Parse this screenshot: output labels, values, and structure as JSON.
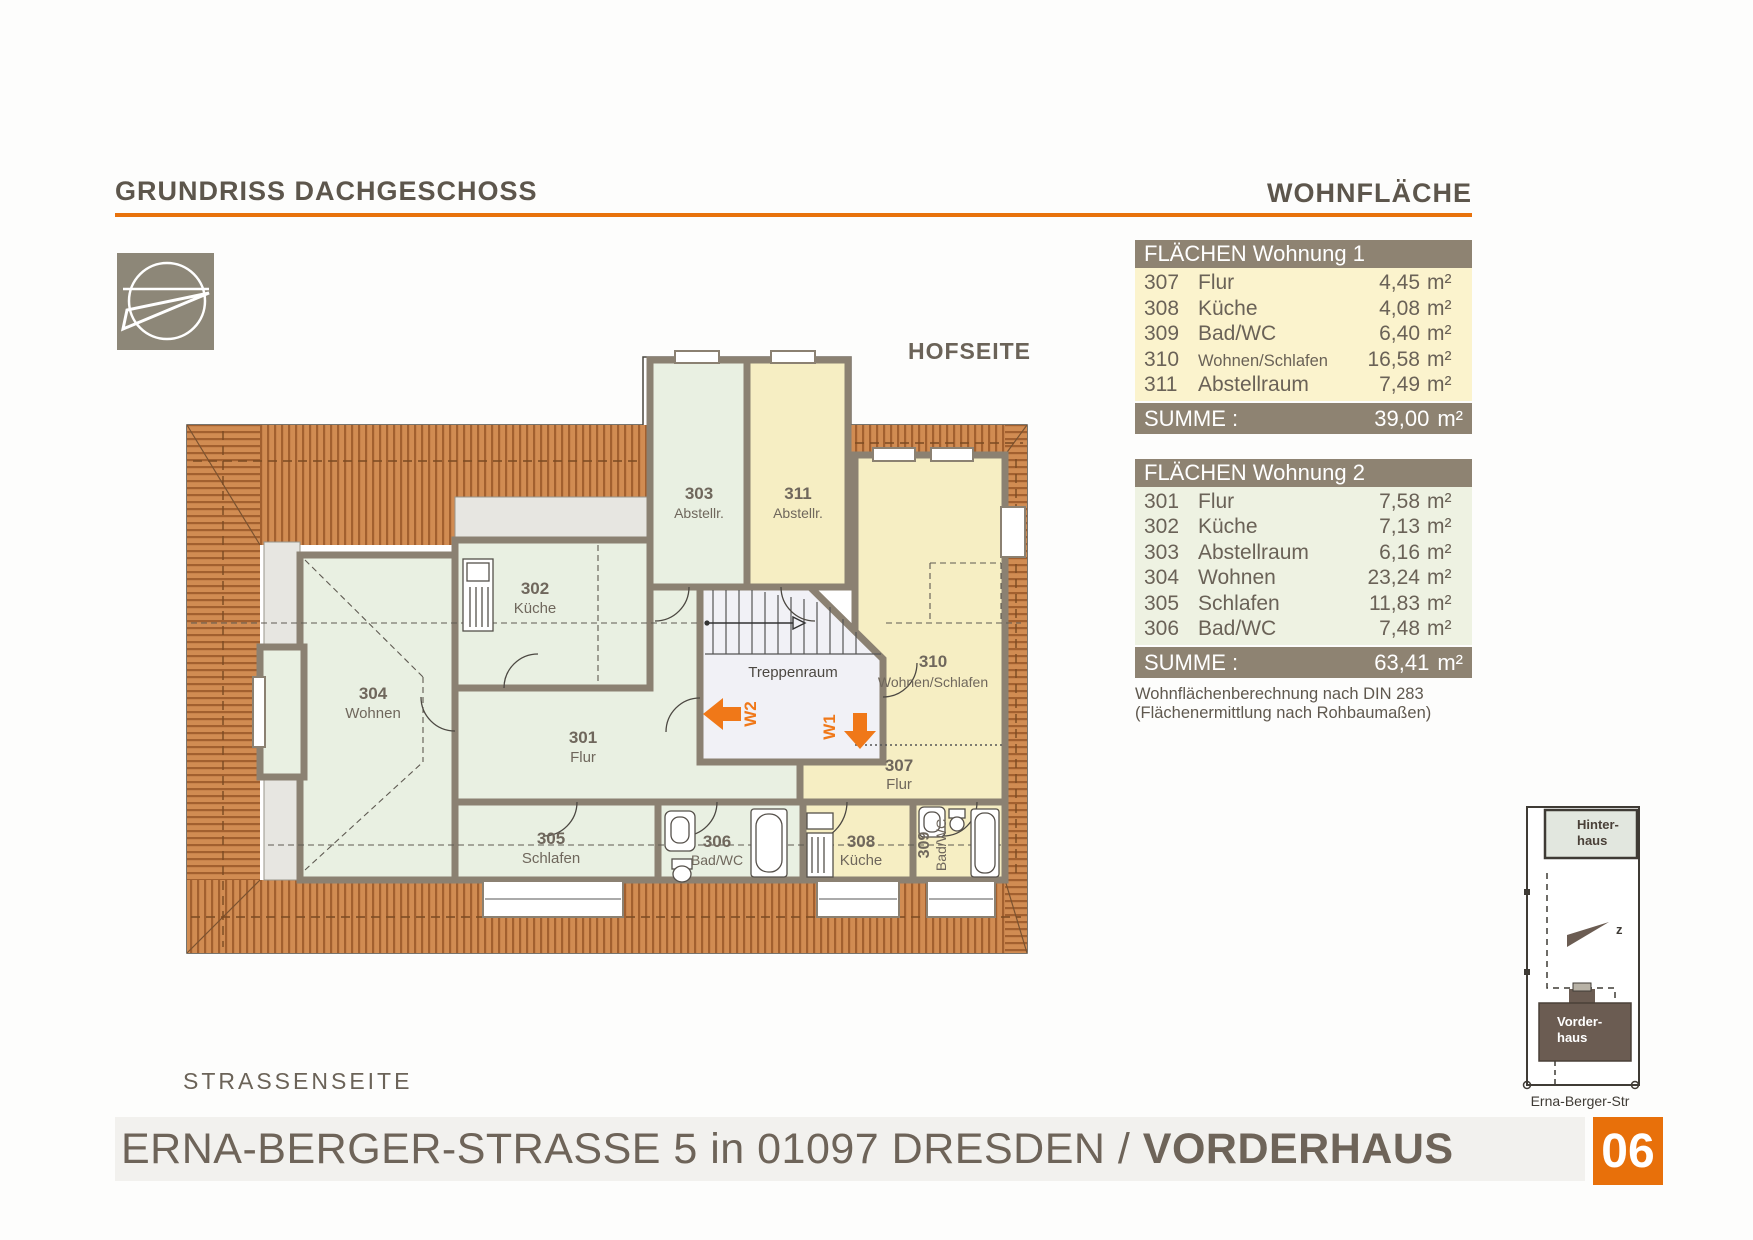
{
  "header": {
    "title": "GRUNDRISS DACHGESCHOSS",
    "right_heading": "WOHNFLÄCHE"
  },
  "plan": {
    "hofseite": "HOFSEITE",
    "strassenseite": "STRASSENSEITE",
    "treppenraum": "Treppenraum",
    "entrance_w1": "W1",
    "entrance_w2": "W2",
    "rooms": [
      {
        "number": "301",
        "name": "Flur"
      },
      {
        "number": "302",
        "name": "Küche"
      },
      {
        "number": "303",
        "name": "Abstellr."
      },
      {
        "number": "304",
        "name": "Wohnen"
      },
      {
        "number": "305",
        "name": "Schlafen"
      },
      {
        "number": "306",
        "name": "Bad/WC"
      },
      {
        "number": "307",
        "name": "Flur"
      },
      {
        "number": "308",
        "name": "Küche"
      },
      {
        "number": "309",
        "name": "Bad/WC"
      },
      {
        "number": "310",
        "name": "Wohnen/Schlafen"
      },
      {
        "number": "311",
        "name": "Abstellr."
      }
    ]
  },
  "tables": {
    "unit": "m²",
    "wohnung1": {
      "title": "FLÄCHEN Wohnung 1",
      "rows": [
        {
          "no": "307",
          "name": "Flur",
          "area": "4,45"
        },
        {
          "no": "308",
          "name": "Küche",
          "area": "4,08"
        },
        {
          "no": "309",
          "name": "Bad/WC",
          "area": "6,40"
        },
        {
          "no": "310",
          "name": "Wohnen/Schlafen",
          "area": "16,58"
        },
        {
          "no": "311",
          "name": "Abstellraum",
          "area": "7,49"
        }
      ],
      "sum_label": "SUMME :",
      "sum_area": "39,00"
    },
    "wohnung2": {
      "title": "FLÄCHEN Wohnung 2",
      "rows": [
        {
          "no": "301",
          "name": "Flur",
          "area": "7,58"
        },
        {
          "no": "302",
          "name": "Küche",
          "area": "7,13"
        },
        {
          "no": "303",
          "name": "Abstellraum",
          "area": "6,16"
        },
        {
          "no": "304",
          "name": "Wohnen",
          "area": "23,24"
        },
        {
          "no": "305",
          "name": "Schlafen",
          "area": "11,83"
        },
        {
          "no": "306",
          "name": "Bad/WC",
          "area": "7,48"
        }
      ],
      "sum_label": "SUMME :",
      "sum_area": "63,41"
    },
    "note_line1": "Wohnflächenberechnung nach DIN 283",
    "note_line2": "(Flächenermittlung nach Rohbaumaßen)"
  },
  "site_map": {
    "hinterhaus_line1": "Hinter-",
    "hinterhaus_line2": "haus",
    "vorderhaus_line1": "Vorder-",
    "vorderhaus_line2": "haus",
    "street": "Erna-Berger-Str",
    "north_mark": "z"
  },
  "footer": {
    "address_regular": "ERNA-BERGER-STRASSE 5 in 01097 DRESDEN / ",
    "address_bold": "VORDERHAUS",
    "sheet_number": "06"
  },
  "colors": {
    "accent_orange": "#e8720c",
    "wall": "#8b8172",
    "roof": "#cd8a52",
    "room_green": "#e9f0e2",
    "room_yellow": "#f6eec3",
    "bar_brown": "#8e8372",
    "table1_bg": "#fbf3cd",
    "table2_bg": "#eef2e2",
    "text_brown": "#655d52"
  }
}
